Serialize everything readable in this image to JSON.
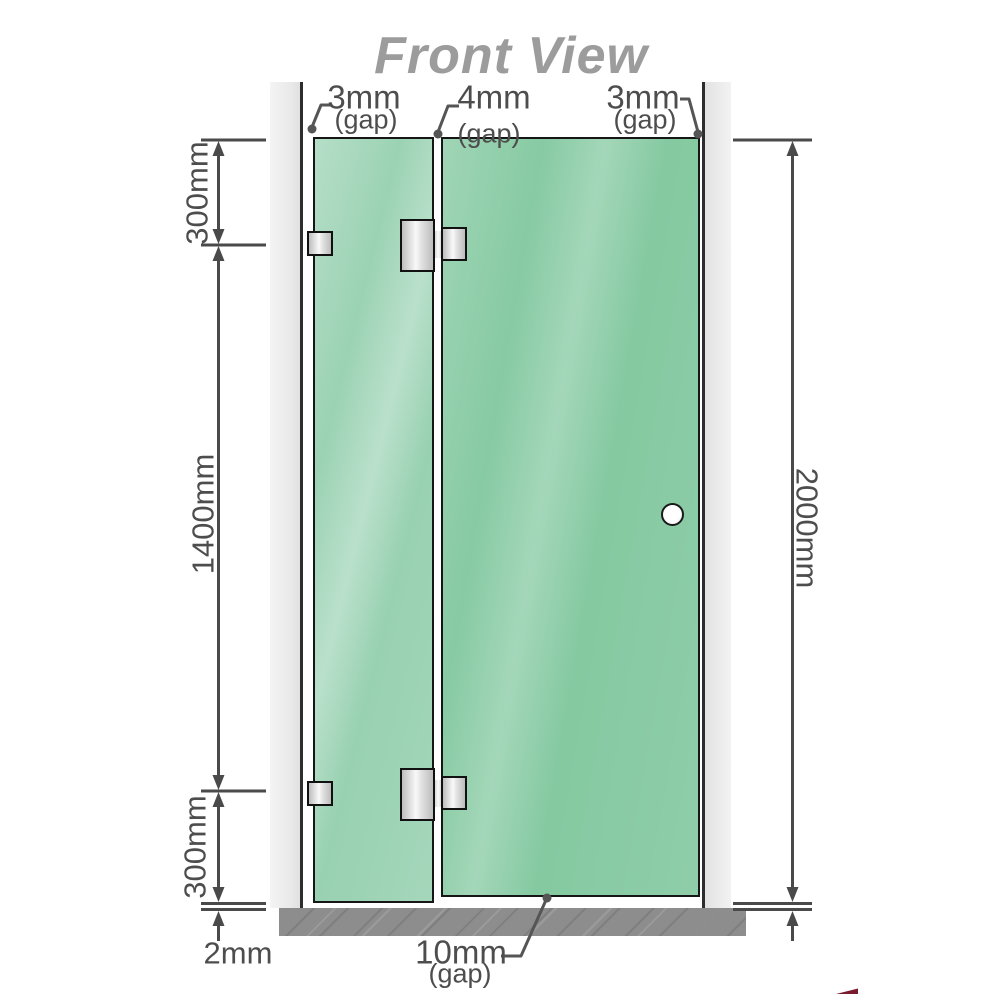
{
  "title": "Front View",
  "gap_labels": {
    "left": {
      "value": "3mm",
      "suffix": "(gap)"
    },
    "middle": {
      "value": "4mm",
      "suffix": "(gap)"
    },
    "right": {
      "value": "3mm",
      "suffix": "(gap)"
    },
    "bottom": {
      "value": "10mm",
      "suffix": "(gap)"
    }
  },
  "dimension_labels": {
    "top_section": "300mm",
    "middle_section": "1400mm",
    "bottom_section": "300mm",
    "overall_height": "2000mm",
    "floor_clearance": "2mm"
  },
  "colors": {
    "line": "#4a4a4a",
    "text": "#4d4d4d",
    "title": "#9c9c9c",
    "glass_fixed": "#96d0b0",
    "glass_door": "#82c89f",
    "glass_border": "#161616",
    "wall_channel": "#e9e9e9",
    "floor": "#8d8d8d",
    "metal_hardware": "#e2e2e2",
    "logo_accent": "#7a1b2e"
  }
}
